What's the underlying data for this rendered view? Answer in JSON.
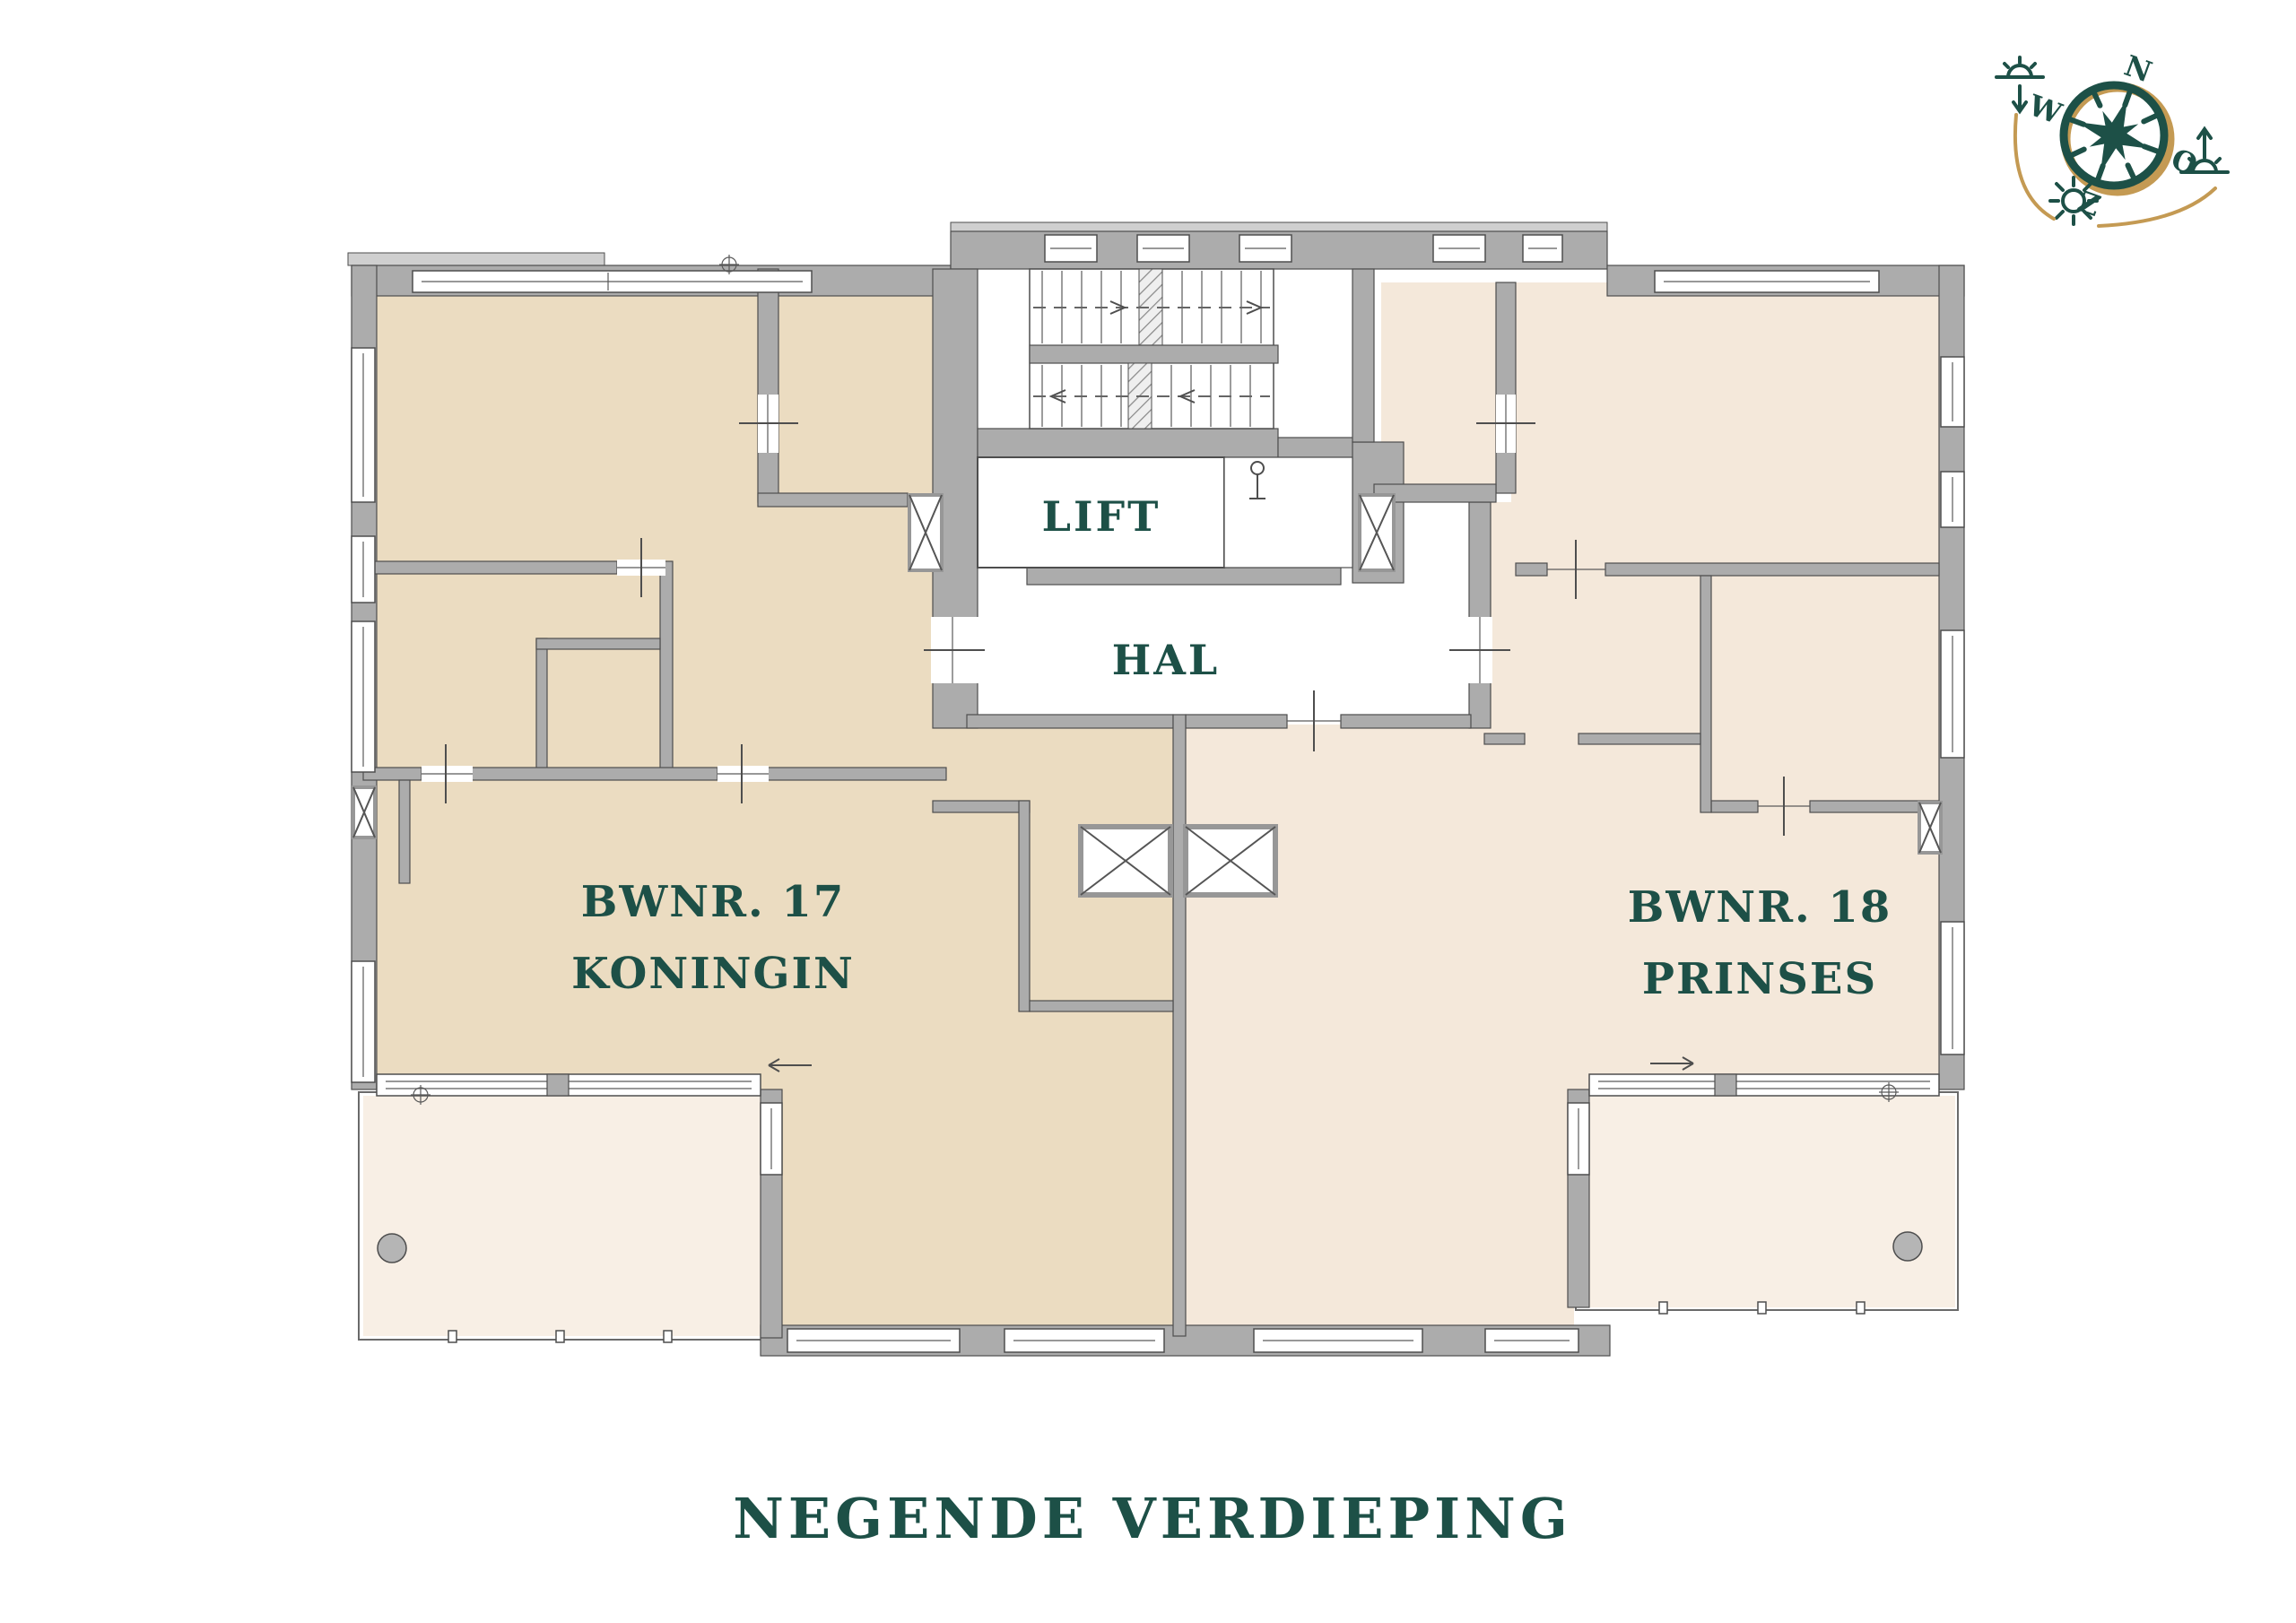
{
  "page": {
    "background": "#ffffff"
  },
  "title": {
    "text": "NEGENDE VERDIEPING"
  },
  "floor_plan": {
    "rooms": {
      "lift_label": "LIFT",
      "hal_label": "HAL"
    },
    "apartments": {
      "left": {
        "number": "BWNR. 17",
        "name": "KONINGIN"
      },
      "right": {
        "number": "BWNR. 18",
        "name": "PRINSES"
      }
    },
    "colors": {
      "apartment_left_fill": "#ebdcc1",
      "apartment_right_fill": "#f4e8da",
      "terrace_fill": "#f8efe5",
      "wall_fill": "#acacac",
      "wall_outline": "#4e4e4e",
      "label_green": "#1d5047",
      "compass_gold": "#c49a53"
    }
  },
  "compass": {
    "labels": {
      "north": "N",
      "east": "O",
      "south": "Z",
      "west": "W"
    },
    "icons": [
      "compass-rose-icon",
      "sunset-icon",
      "sun-icon",
      "sunrise-icon"
    ]
  }
}
